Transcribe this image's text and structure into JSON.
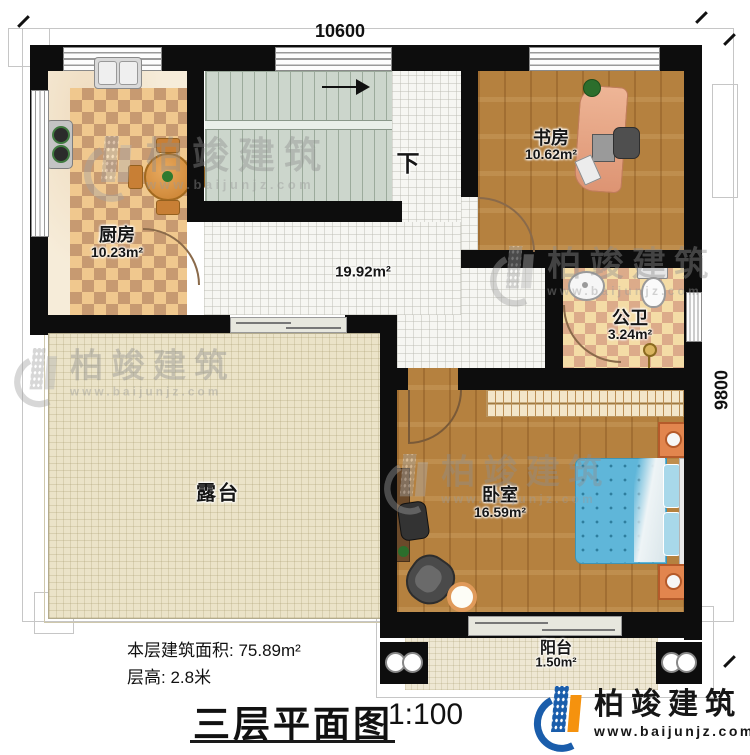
{
  "plan": {
    "dimension_top": "10600",
    "dimension_right": "9800",
    "stairs_label": "下",
    "rooms": {
      "kitchen": {
        "name": "厨房",
        "area": "10.23m²"
      },
      "study": {
        "name": "书房",
        "area": "10.62m²"
      },
      "hall": {
        "area": "19.92m²"
      },
      "bathroom": {
        "name": "公卫",
        "area": "3.24m²"
      },
      "bedroom": {
        "name": "卧室",
        "area": "16.59m²"
      },
      "terrace": {
        "name": "露台"
      },
      "balcony": {
        "name": "阳台",
        "area": "1.50m²"
      }
    }
  },
  "footer": {
    "floor_area_label": "本层建筑面积: 75.89m²",
    "floor_height_label": "层高: 2.8米",
    "title": "三层平面图",
    "scale": "1:100"
  },
  "branding": {
    "company": "柏竣建筑",
    "website": "www.baijunjz.com"
  },
  "watermark": {
    "company": "柏竣建筑",
    "website": "www.baijunjz.com"
  },
  "colors": {
    "wall": "#0d0d0d",
    "wood_floor": "#b5813f",
    "kitchen_checker": "#f0c88e",
    "bath_checker": "#f4dca6",
    "stair_floor": "#ccd6cc",
    "terrace_floor": "#ebe3c8",
    "bed_blue": "#5fb6d9",
    "brand_blue": "#1a5dab",
    "brand_orange": "#f5920e"
  }
}
